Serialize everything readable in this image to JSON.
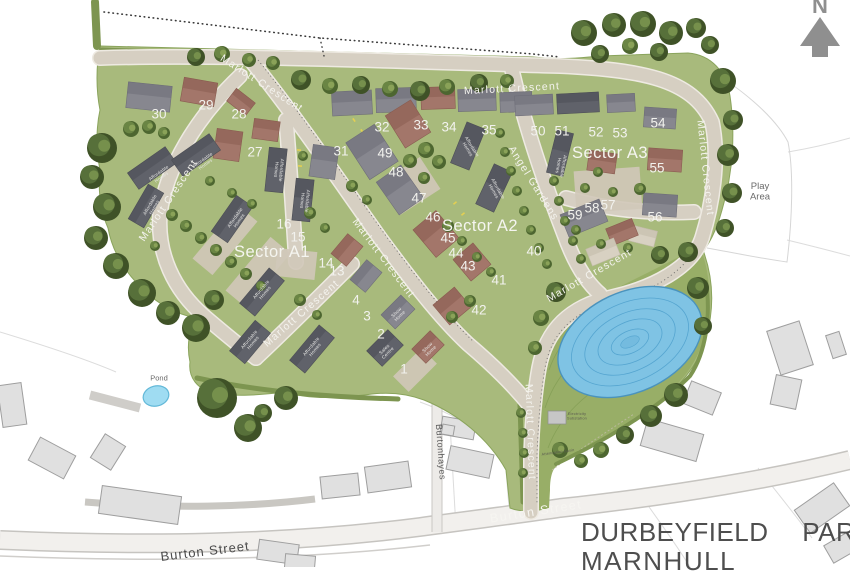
{
  "title": {
    "line1": "DURBEYFIELD PARK,",
    "line2": "MARNHULL"
  },
  "north_label": "N",
  "colors": {
    "grass": "#a8ba7c",
    "grass_dark": "#93a965",
    "hedge": "#7d9550",
    "road": "#d6cfc2",
    "road_casing": "#eeeae2",
    "pond_blue": "#7fc3e4",
    "pond_outline": "#4a93bd",
    "small_pond": "#9fdcf2",
    "building_red": "#a3766a",
    "building_grey": "#87878f",
    "building_dark": "#60626a",
    "building_beige": "#d8d1c2",
    "context_building": "#e0e0e0",
    "title_text": "#4e4e4e",
    "north_arrow": "#8f8f8f",
    "label_white": "#f4f3ee"
  },
  "map": {
    "sectors": [
      {
        "label": "Sector A1",
        "x": 272,
        "y": 251
      },
      {
        "label": "Sector A2",
        "x": 480,
        "y": 225
      },
      {
        "label": "Sector A3",
        "x": 610,
        "y": 152
      }
    ],
    "streets": [
      {
        "label": "Marlott Crescent",
        "x": 262,
        "y": 83,
        "rot": 33,
        "style": "site"
      },
      {
        "label": "Marlott Crescent",
        "x": 512,
        "y": 88,
        "rot": -3,
        "style": "site"
      },
      {
        "label": "Marlott Crescent",
        "x": 706,
        "y": 168,
        "rot": 84,
        "style": "site"
      },
      {
        "label": "Marlott Crescent",
        "x": 168,
        "y": 200,
        "rot": -56,
        "style": "site"
      },
      {
        "label": "Marlott Crescent",
        "x": 384,
        "y": 258,
        "rot": 53,
        "style": "site"
      },
      {
        "label": "Marlott Crescent",
        "x": 301,
        "y": 313,
        "rot": -41,
        "style": "site"
      },
      {
        "label": "Marlott Crescent",
        "x": 589,
        "y": 275,
        "rot": -30,
        "style": "site"
      },
      {
        "label": "Marlott Crescent",
        "x": 531,
        "y": 432,
        "rot": 88,
        "style": "site"
      },
      {
        "label": "Angel Gardens",
        "x": 534,
        "y": 183,
        "rot": 58,
        "style": "site"
      },
      {
        "label": "Burton Street",
        "x": 536,
        "y": 511,
        "rot": -9,
        "style": "onroad"
      },
      {
        "label": "Burton Street",
        "x": 205,
        "y": 551,
        "rot": -7,
        "style": "context"
      },
      {
        "label": "Burtonhayes",
        "x": 441,
        "y": 452,
        "rot": 86,
        "style": "context_small"
      }
    ],
    "plots": [
      {
        "n": "1",
        "x": 404,
        "y": 369
      },
      {
        "n": "2",
        "x": 381,
        "y": 334
      },
      {
        "n": "3",
        "x": 367,
        "y": 316
      },
      {
        "n": "4",
        "x": 356,
        "y": 300
      },
      {
        "n": "13",
        "x": 337,
        "y": 271
      },
      {
        "n": "14",
        "x": 326,
        "y": 263
      },
      {
        "n": "15",
        "x": 298,
        "y": 237
      },
      {
        "n": "16",
        "x": 284,
        "y": 224
      },
      {
        "n": "27",
        "x": 255,
        "y": 152
      },
      {
        "n": "28",
        "x": 239,
        "y": 114
      },
      {
        "n": "29",
        "x": 206,
        "y": 105
      },
      {
        "n": "30",
        "x": 159,
        "y": 114
      },
      {
        "n": "31",
        "x": 341,
        "y": 151
      },
      {
        "n": "32",
        "x": 382,
        "y": 127
      },
      {
        "n": "33",
        "x": 421,
        "y": 125
      },
      {
        "n": "34",
        "x": 449,
        "y": 127
      },
      {
        "n": "35",
        "x": 489,
        "y": 130
      },
      {
        "n": "40",
        "x": 534,
        "y": 251
      },
      {
        "n": "41",
        "x": 499,
        "y": 280
      },
      {
        "n": "42",
        "x": 479,
        "y": 310
      },
      {
        "n": "43",
        "x": 468,
        "y": 266
      },
      {
        "n": "44",
        "x": 456,
        "y": 253
      },
      {
        "n": "45",
        "x": 448,
        "y": 238
      },
      {
        "n": "46",
        "x": 433,
        "y": 217
      },
      {
        "n": "47",
        "x": 419,
        "y": 198
      },
      {
        "n": "48",
        "x": 396,
        "y": 172
      },
      {
        "n": "49",
        "x": 385,
        "y": 153
      },
      {
        "n": "50",
        "x": 538,
        "y": 131
      },
      {
        "n": "51",
        "x": 562,
        "y": 131
      },
      {
        "n": "52",
        "x": 596,
        "y": 132
      },
      {
        "n": "53",
        "x": 620,
        "y": 133
      },
      {
        "n": "54",
        "x": 658,
        "y": 123
      },
      {
        "n": "55",
        "x": 657,
        "y": 168
      },
      {
        "n": "56",
        "x": 655,
        "y": 217
      },
      {
        "n": "57",
        "x": 608,
        "y": 205
      },
      {
        "n": "58",
        "x": 592,
        "y": 208
      },
      {
        "n": "59",
        "x": 575,
        "y": 215
      }
    ],
    "amenities": [
      {
        "label": "Play Area",
        "lines": [
          "Play",
          "Area"
        ],
        "x": 760,
        "y": 191
      },
      {
        "label": "Pond",
        "lines": [
          "Pond"
        ],
        "x": 159,
        "y": 378
      }
    ],
    "building_labels": [
      {
        "text": "Affordable Homes",
        "lines": [
          "Affordable",
          "Homes"
        ],
        "x": 160,
        "y": 175,
        "rot": -35
      },
      {
        "text": "Affordable Homes",
        "lines": [
          "Affordable",
          "Homes"
        ],
        "x": 204,
        "y": 162,
        "rot": -35
      },
      {
        "text": "Affordable Homes",
        "lines": [
          "Affordable",
          "Homes"
        ],
        "x": 152,
        "y": 206,
        "rot": -60
      },
      {
        "text": "Affordable Homes",
        "lines": [
          "Affordable",
          "Homes"
        ],
        "x": 237,
        "y": 219,
        "rot": -55
      },
      {
        "text": "Affordable Homes",
        "lines": [
          "Affordable",
          "Homes"
        ],
        "x": 263,
        "y": 291,
        "rot": -50
      },
      {
        "text": "Affordable Homes",
        "lines": [
          "Affordable",
          "Homes"
        ],
        "x": 251,
        "y": 341,
        "rot": -50
      },
      {
        "text": "Affordable Homes",
        "lines": [
          "Affordable",
          "Homes"
        ],
        "x": 313,
        "y": 348,
        "rot": -50
      },
      {
        "text": "Affordable Homes",
        "lines": [
          "Affordable",
          "Homes"
        ],
        "x": 279,
        "y": 170,
        "rot": 95
      },
      {
        "text": "Affordable Homes",
        "lines": [
          "Affordable",
          "Homes"
        ],
        "x": 305,
        "y": 201,
        "rot": 95
      },
      {
        "text": "Affordable Homes",
        "lines": [
          "Affordable",
          "Homes"
        ],
        "x": 470,
        "y": 148,
        "rot": 58
      },
      {
        "text": "Affordable Homes",
        "lines": [
          "Affordable",
          "Homes"
        ],
        "x": 496,
        "y": 190,
        "rot": 60
      },
      {
        "text": "Affordable Homes",
        "lines": [
          "Affordable",
          "Homes"
        ],
        "x": 561,
        "y": 166,
        "rot": 100
      },
      {
        "text": "Show Home",
        "lines": [
          "Show",
          "Home"
        ],
        "x": 398,
        "y": 314,
        "rot": -45
      },
      {
        "text": "Show Home",
        "lines": [
          "Show",
          "Home"
        ],
        "x": 429,
        "y": 349,
        "rot": -45
      },
      {
        "text": "Sales Centre",
        "lines": [
          "Sales",
          "Centre"
        ],
        "x": 386,
        "y": 351,
        "rot": -45
      },
      {
        "text": "Electricity Substation",
        "lines": [
          "Electricity",
          "Substation"
        ],
        "x": 577,
        "y": 416,
        "rot": 0
      },
      {
        "text": "Attenuation Basin",
        "lines": [
          "Attenuation Basin"
        ],
        "x": 558,
        "y": 452,
        "rot": -8
      }
    ]
  }
}
